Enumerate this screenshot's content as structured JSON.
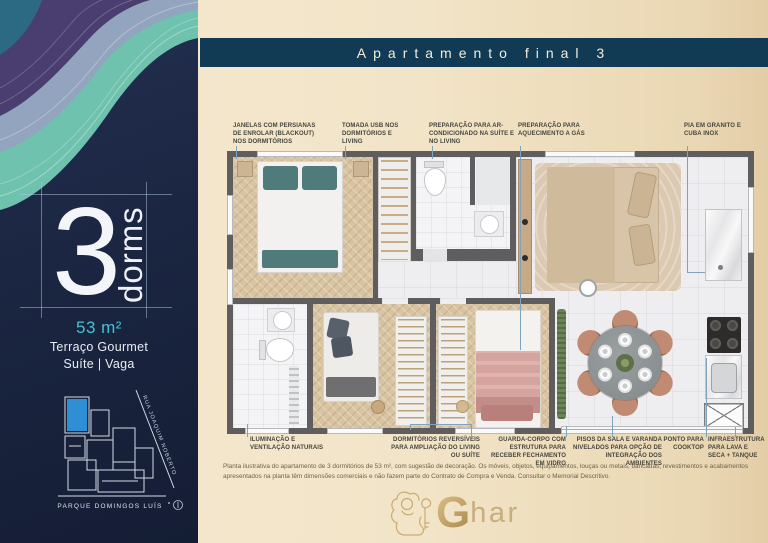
{
  "header": {
    "title": "Apartamento final 3"
  },
  "sidebar": {
    "dorms_value": "3",
    "dorms_unit": "dorms",
    "area": "53 m²",
    "feature_line1": "Terraço Gourmet",
    "feature_line2": "Suíte | Vaga",
    "map": {
      "street_label": "RUA JOAQUIM NOBERTO",
      "park_label": "PARQUE DOMINGOS LUÍS"
    }
  },
  "callouts": {
    "top": [
      "JANELAS COM PERSIANAS DE ENROLAR (BLACKOUT) NOS DORMITÓRIOS",
      "TOMADA USB NOS DORMITÓRIOS E LIVING",
      "PREPARAÇÃO PARA AR-CONDICIONADO NA SUÍTE E NO LIVING",
      "PREPARAÇÃO PARA AQUECIMENTO A GÁS",
      "PIA EM GRANITO E CUBA INOX"
    ],
    "bottom": [
      "ILUMINAÇÃO E VENTILAÇÃO NATURAIS",
      "DORMITÓRIOS REVERSÍVEIS PARA AMPLIAÇÃO DO LIVING OU SUÍTE",
      "GUARDA-CORPO COM ESTRUTURA PARA RECEBER FECHAMENTO EM VIDRO",
      "PISOS DA SALA E VARANDA NIVELADOS PARA OPÇÃO DE INTEGRAÇÃO DOS AMBIENTES",
      "PONTO PARA COOKTOP",
      "INFRAESTRUTURA PARA LAVA E SECA + TANQUE"
    ]
  },
  "disclaimer": "Planta ilustrativa do apartamento de 3 dormitórios de 53 m², com sugestão de decoração. Os móveis, objetos, equipamentos, louças ou metais, bancadas, revestimentos e acabamentos apresentados na planta têm dimensões comerciais e não fazem parte do Contrato de Compra e Venda. Consultar o Memorial Descritivo.",
  "logo": {
    "initial": "G",
    "rest": "har"
  },
  "colors": {
    "accent_cyan": "#3fc3d8",
    "panel_navy": "#1b2642",
    "title_bar": "#113a54",
    "background_beige": "#f2e4c7",
    "wall_gray": "#5f5d5d",
    "gold": "#c4a061",
    "map_highlight_blue": "#2e8fd4"
  }
}
